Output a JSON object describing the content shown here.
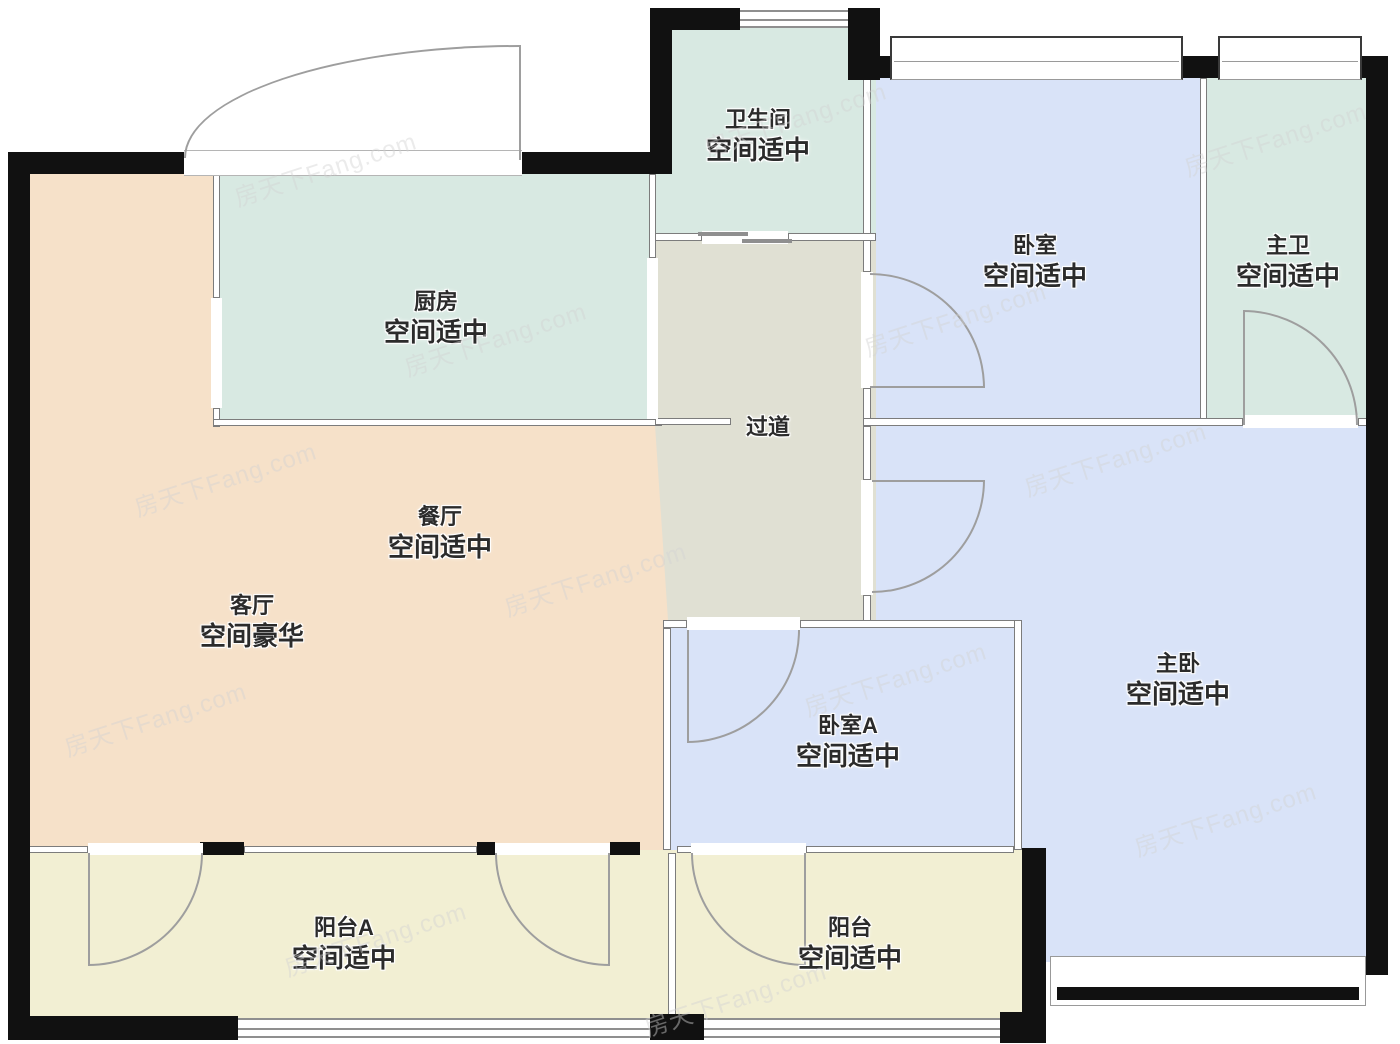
{
  "watermark": {
    "text": "房天下Fang.com"
  },
  "colors": {
    "wall": "#111111",
    "thin_wall": "#7c7c7c",
    "door_line": "#9e9e9e",
    "mint": "#d8e9e2",
    "blue": "#d9e3f8",
    "peach": "#f6e1c9",
    "gray": "#e0e0d3",
    "yellow": "#f2efd3"
  },
  "rooms": [
    {
      "key": "bathroom",
      "name": "卫生间",
      "status": "空间适中",
      "color": "#d8e9e2"
    },
    {
      "key": "bedroom",
      "name": "卧室",
      "status": "空间适中",
      "color": "#d9e3f8"
    },
    {
      "key": "master-bath",
      "name": "主卫",
      "status": "空间适中",
      "color": "#d8e9e2"
    },
    {
      "key": "kitchen",
      "name": "厨房",
      "status": "空间适中",
      "color": "#d8e9e2"
    },
    {
      "key": "hallway",
      "name": "过道",
      "status": "",
      "color": "#e0e0d3"
    },
    {
      "key": "dining",
      "name": "餐厅",
      "status": "空间适中",
      "color": "#f6e1c9"
    },
    {
      "key": "living",
      "name": "客厅",
      "status": "空间豪华",
      "color": "#f6e1c9"
    },
    {
      "key": "bedroom-a",
      "name": "卧室A",
      "status": "空间适中",
      "color": "#d9e3f8"
    },
    {
      "key": "master-bedroom",
      "name": "主卧",
      "status": "空间适中",
      "color": "#d9e3f8"
    },
    {
      "key": "balcony-a",
      "name": "阳台A",
      "status": "空间适中",
      "color": "#f2efd3"
    },
    {
      "key": "balcony",
      "name": "阳台",
      "status": "空间适中",
      "color": "#f2efd3"
    }
  ]
}
